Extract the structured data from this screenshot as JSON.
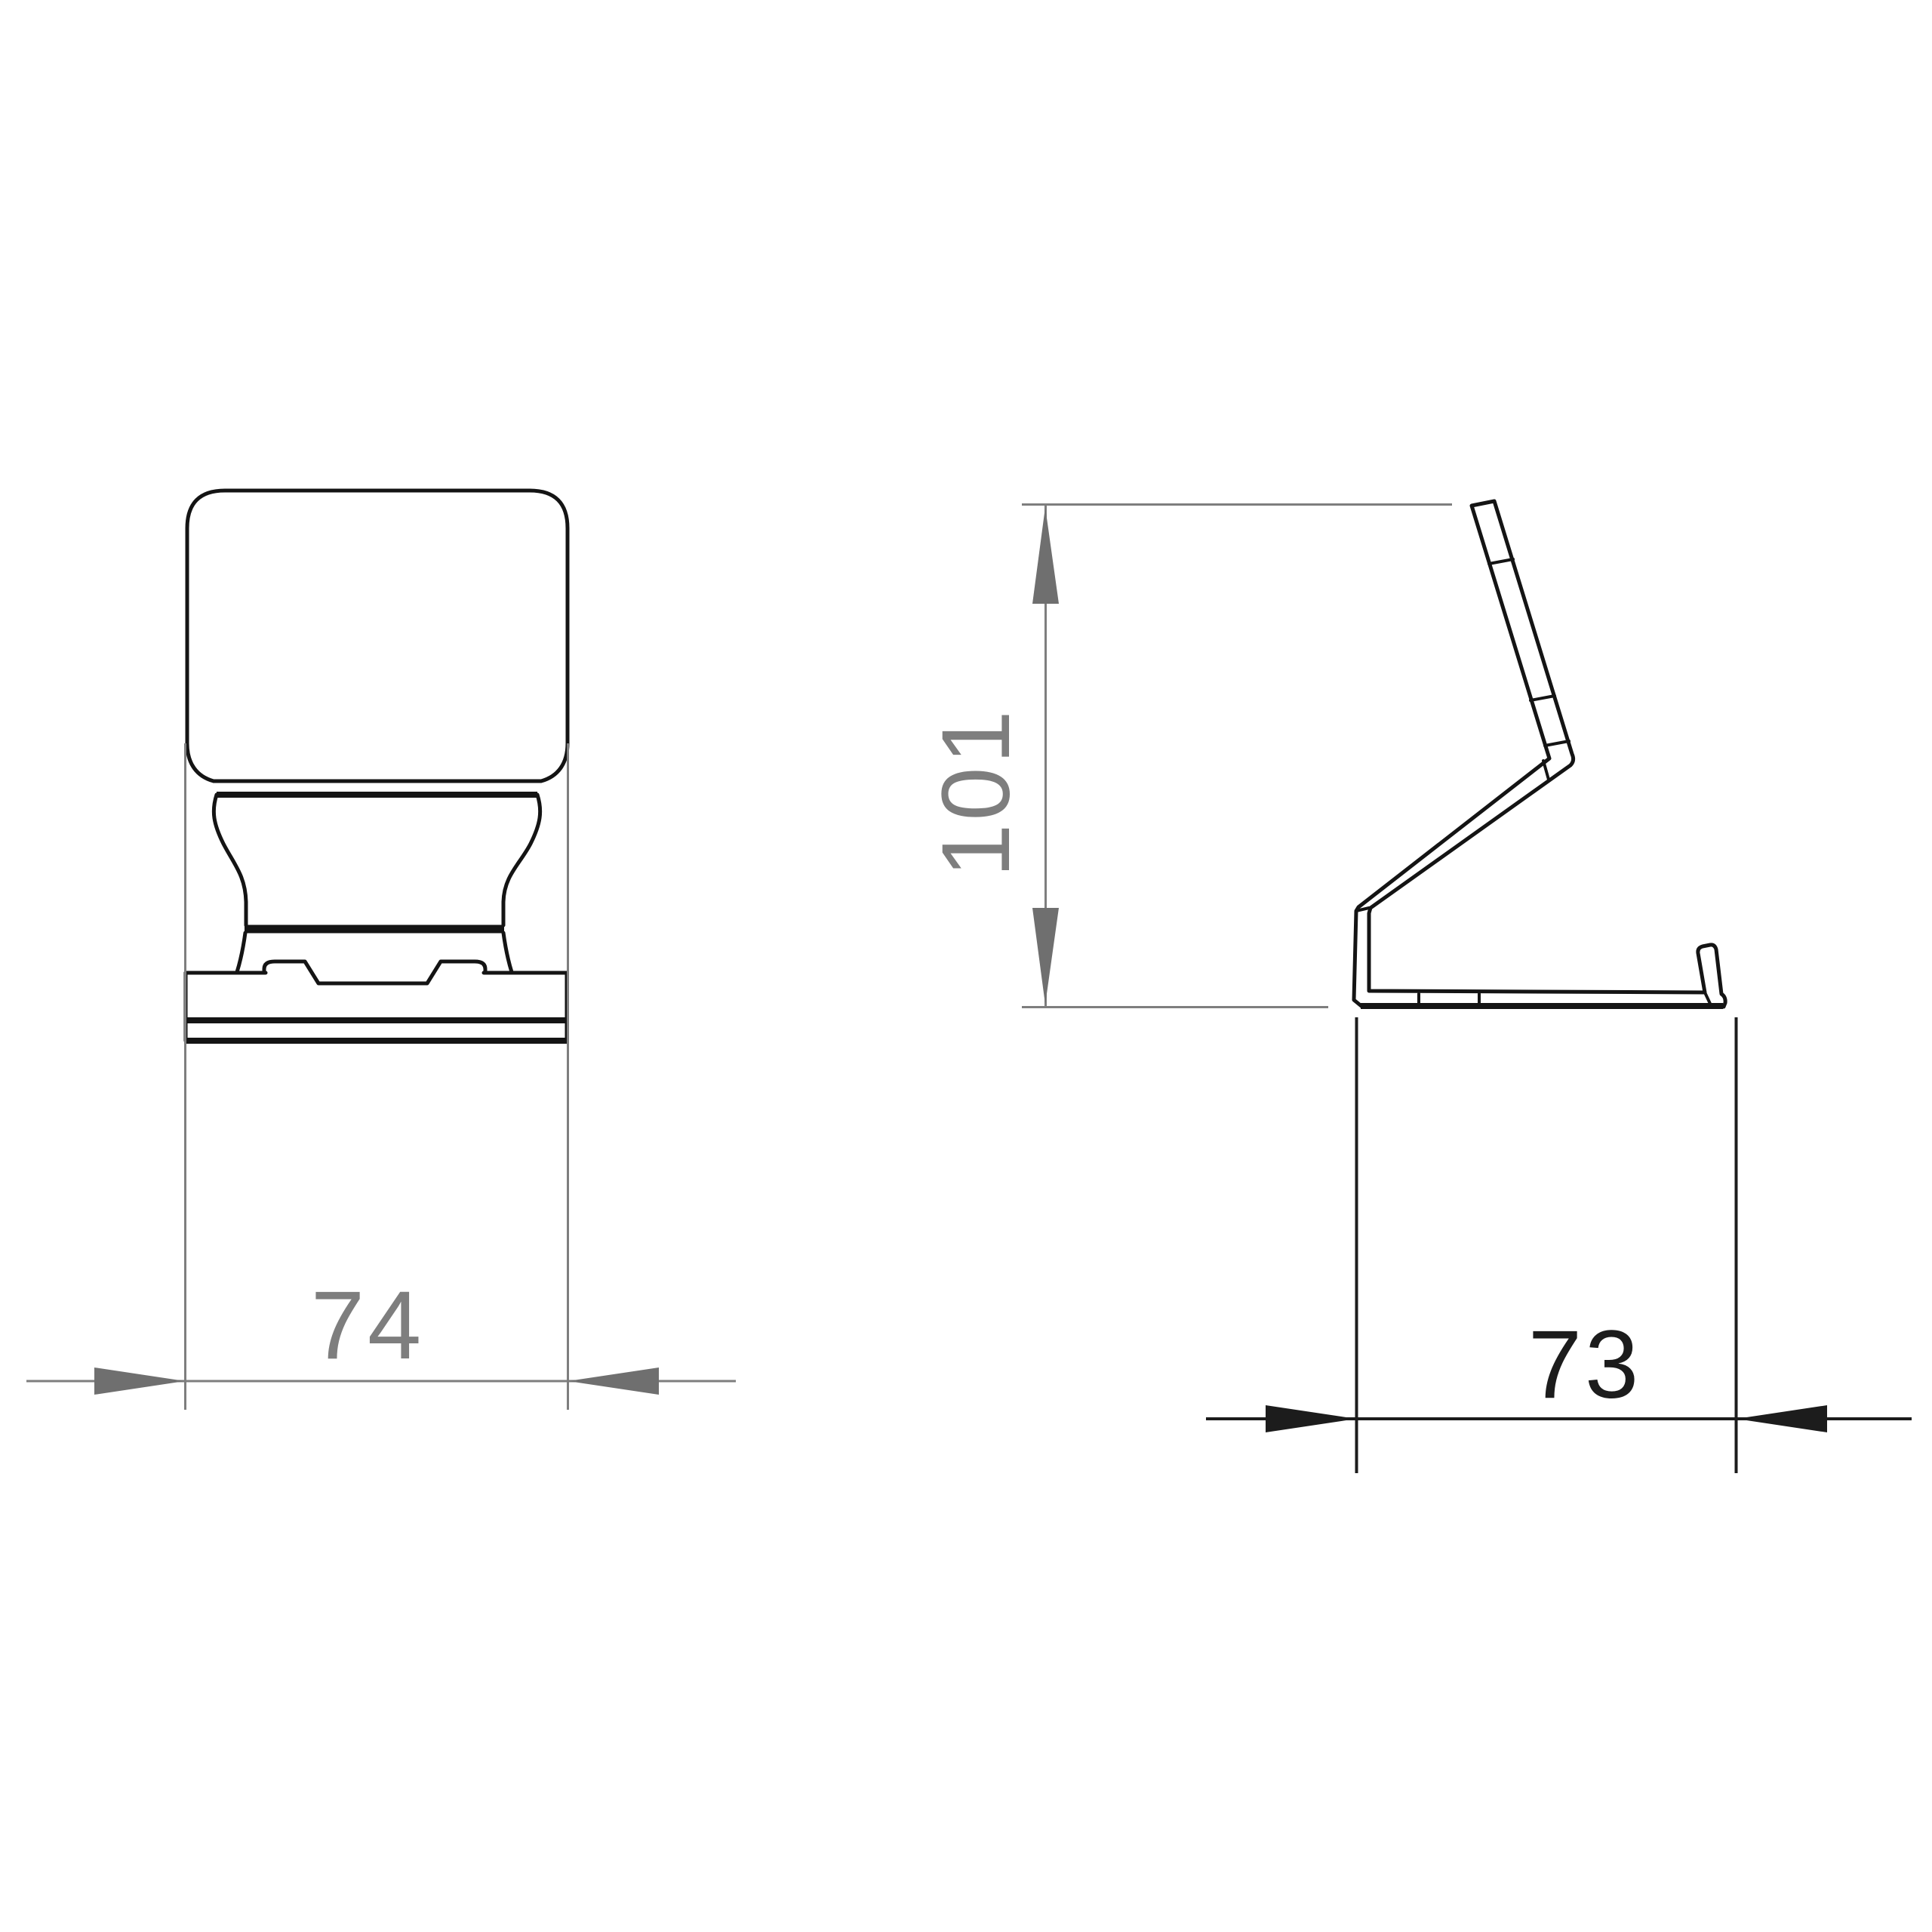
{
  "drawing": {
    "type": "technical-dimension-drawing",
    "views": {
      "front": {
        "label": "front view of stand"
      },
      "side": {
        "label": "side profile of stand"
      }
    },
    "dimensions": {
      "front_width": "74",
      "side_height": "101",
      "side_depth": "73"
    }
  },
  "colors": {
    "background": "#ffffff",
    "object_line": "#141414",
    "dim_gray": "#7e7e7e",
    "dim_gray_text": "#7e7e7e",
    "dim_black": "#1c1c1c",
    "dim_black_text": "#1c1c1c"
  }
}
